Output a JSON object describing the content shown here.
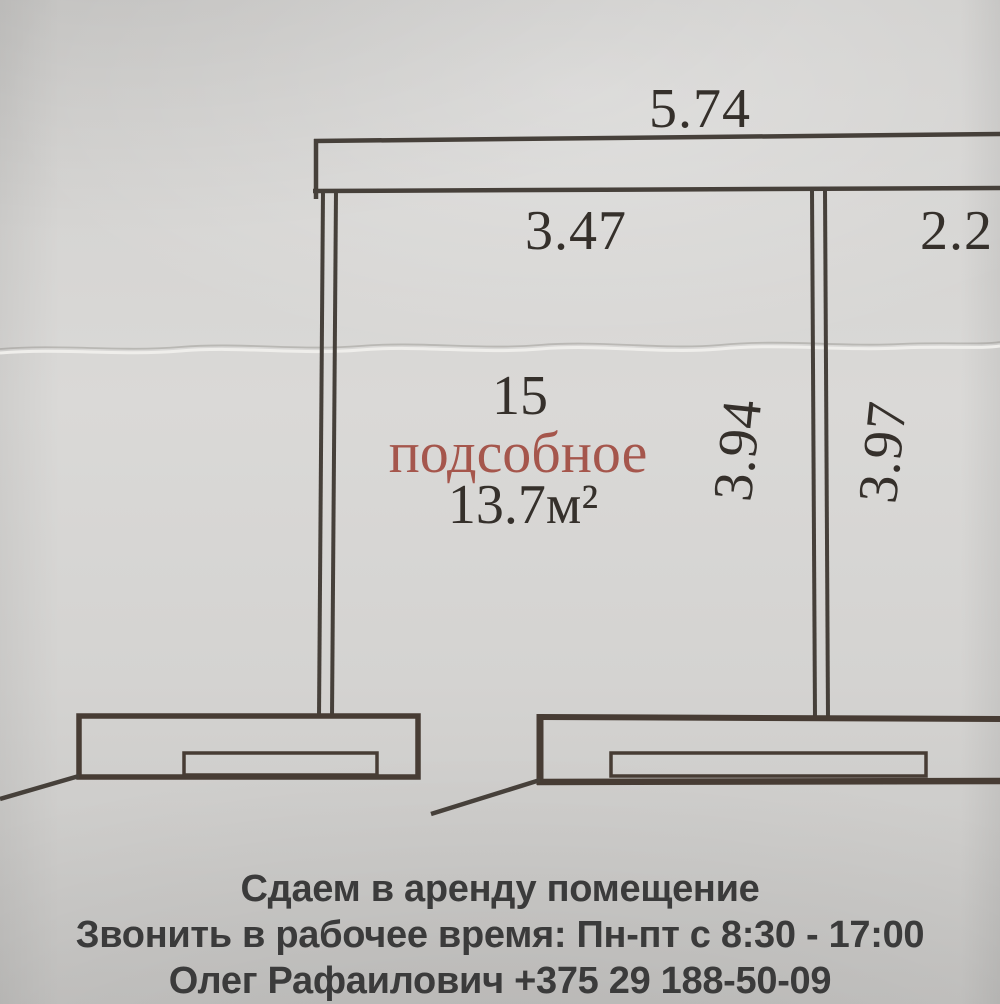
{
  "photo": {
    "floor_plan": {
      "dims": {
        "top_width": "5.74",
        "room_width": "3.47",
        "right_room_width": "2.2",
        "room_height_left": "3.94",
        "room_height_right": "3.97"
      },
      "room": {
        "number": "15",
        "name": "подсобное",
        "area": "13.7м²"
      },
      "colors": {
        "ink": "#46403a",
        "thick_ink": "#473c34",
        "dim_text": "#35302b",
        "room_name_text": "#a5564c",
        "paper": "#d6d5d3"
      }
    },
    "ad": {
      "lines": [
        "Сдаем в аренду помещение",
        "Звонить в рабочее время: Пн-пт с 8:30 - 17:00",
        "Олег Рафаилович +375 29 188-50-09"
      ],
      "text_color": "#3b3b3b"
    }
  }
}
